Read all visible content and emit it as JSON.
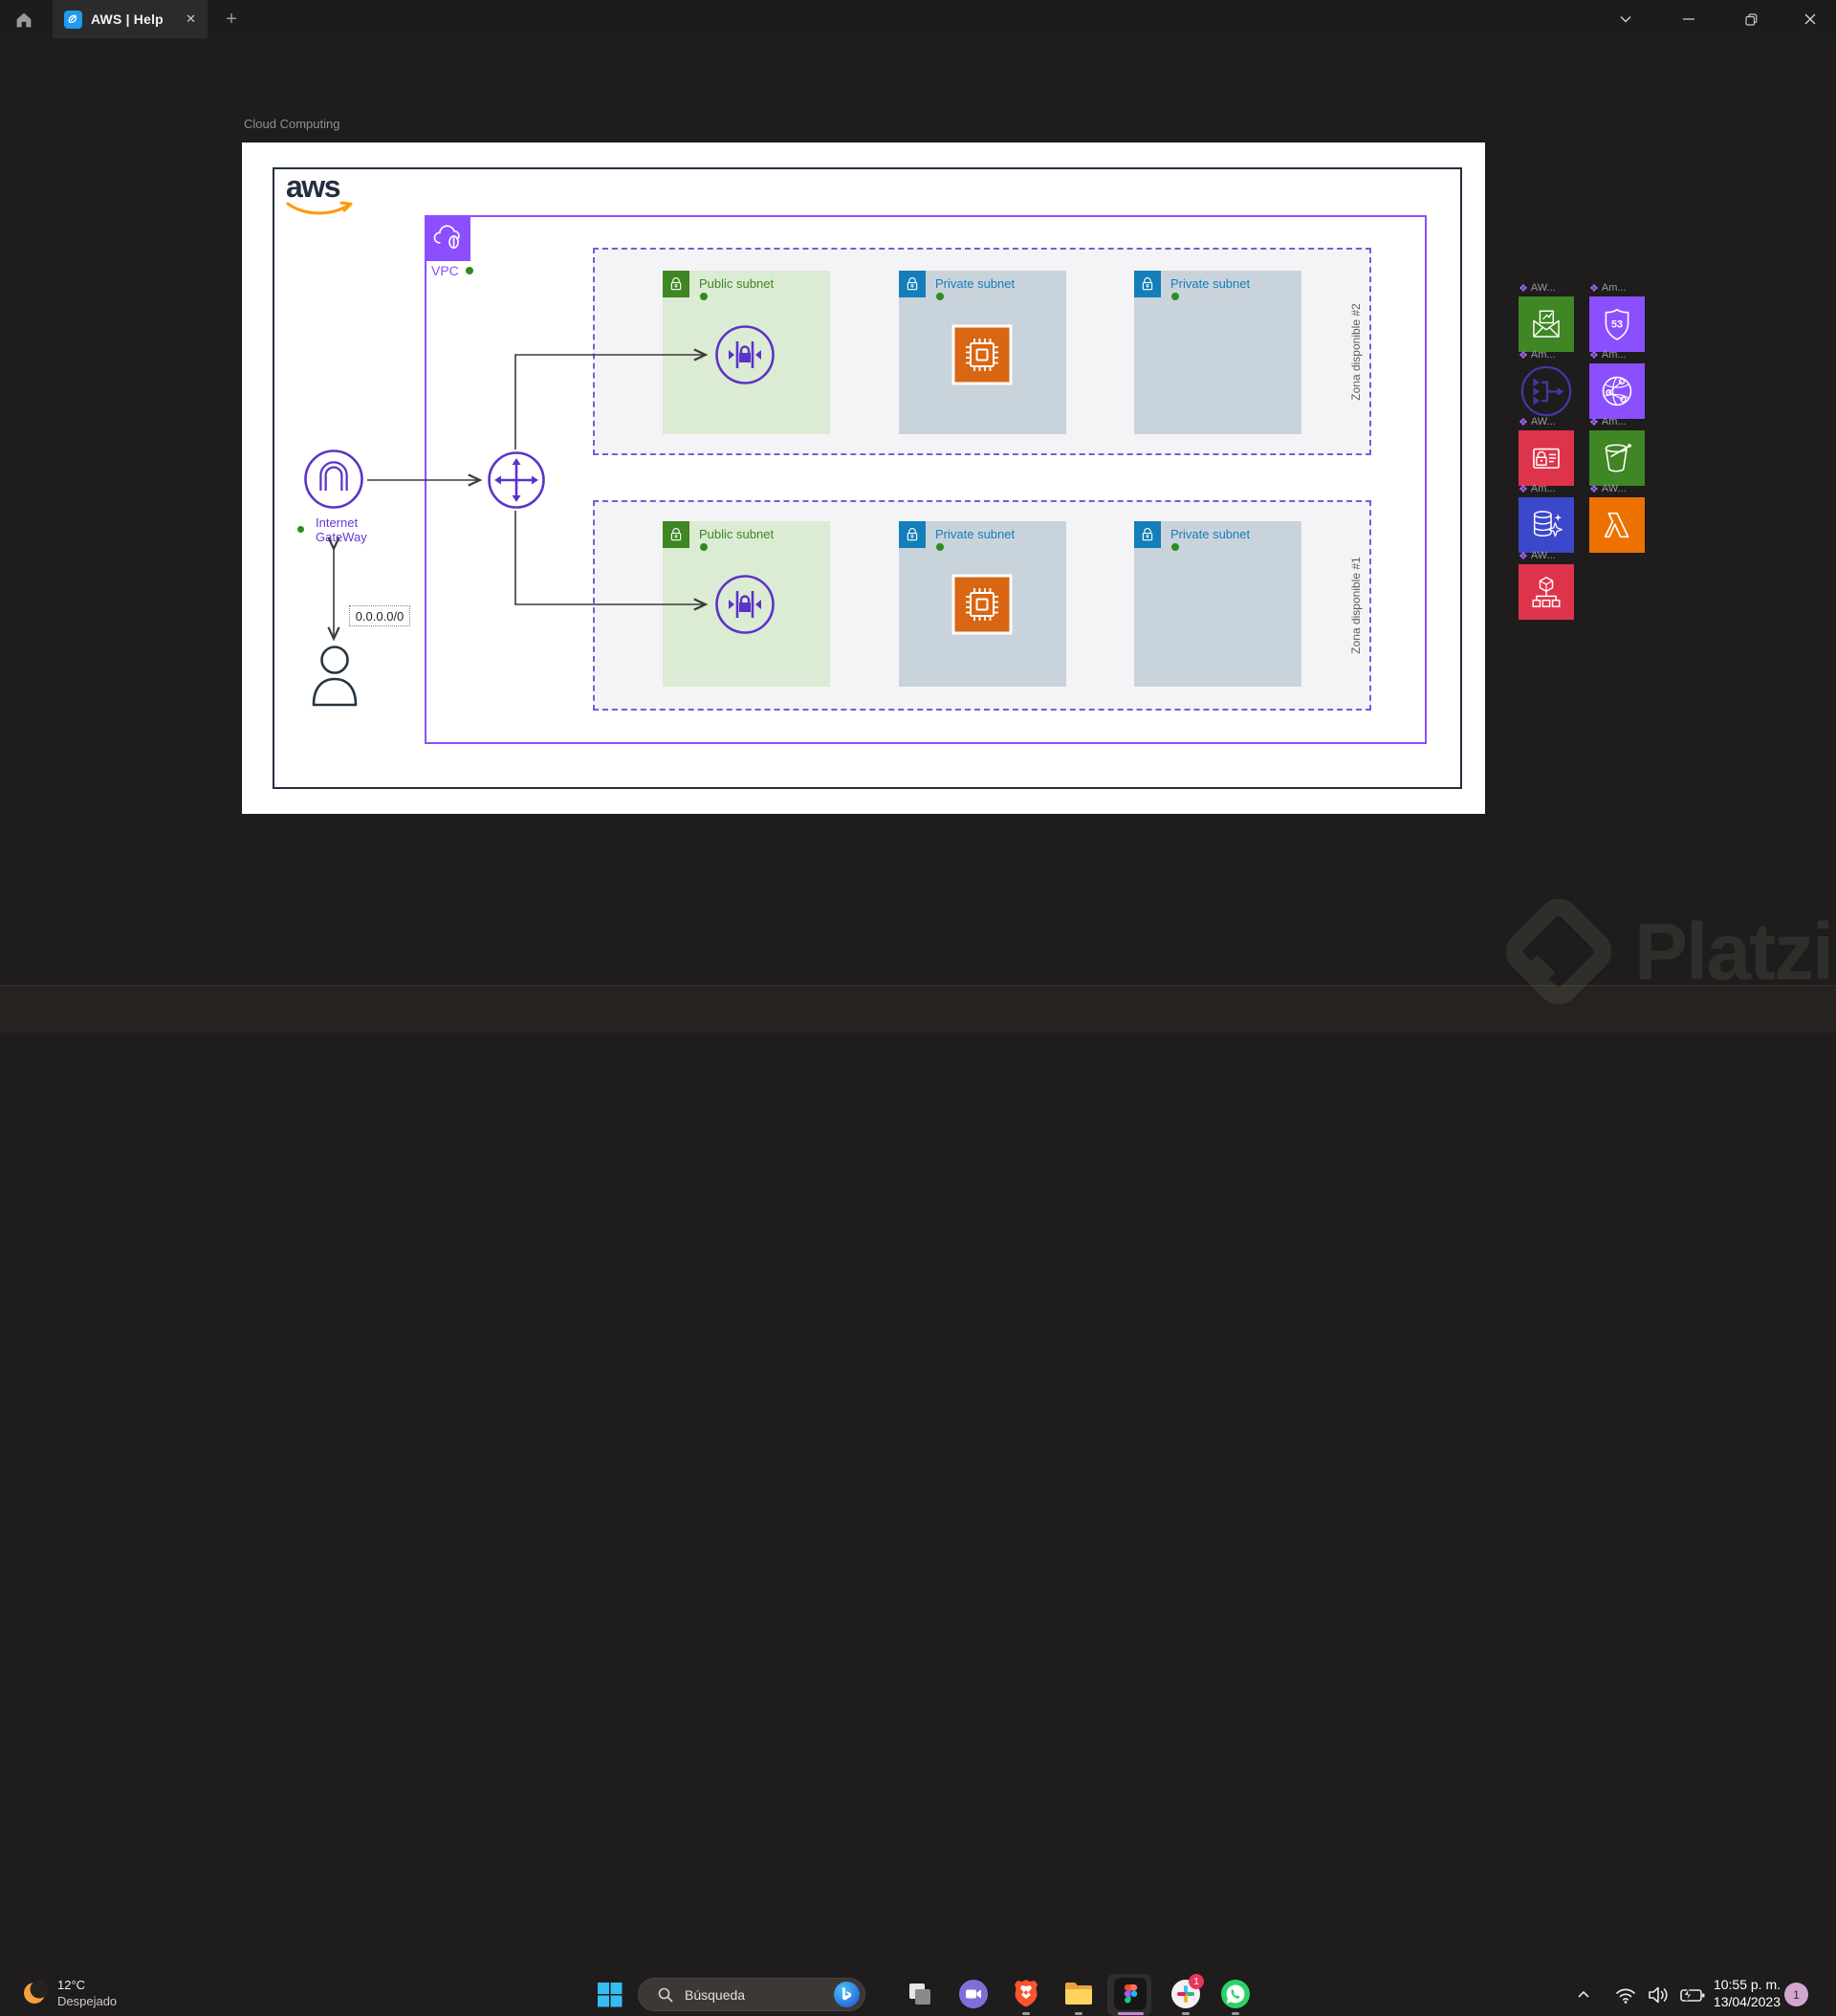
{
  "window": {
    "tab": {
      "title": "AWS | Help"
    },
    "new_tab_label": "+"
  },
  "canvas": {
    "frame_label": "Cloud Computing",
    "aws_logo_text": "aws",
    "vpc": {
      "label": "VPC"
    },
    "internet_gateway": {
      "label_line1": "Internet",
      "label_line2": "GateWay"
    },
    "route_cidr": "0.0.0.0/0",
    "zones": [
      {
        "name": "Zona disponible #2",
        "subnets": [
          {
            "label": "Public subnet",
            "type": "public"
          },
          {
            "label": "Private subnet",
            "type": "private",
            "has_ec2": true
          },
          {
            "label": "Private subnet",
            "type": "private",
            "has_ec2": false
          }
        ]
      },
      {
        "name": "Zona disponible #1",
        "subnets": [
          {
            "label": "Public subnet",
            "type": "public"
          },
          {
            "label": "Private subnet",
            "type": "private",
            "has_ec2": true
          },
          {
            "label": "Private subnet",
            "type": "private",
            "has_ec2": false
          }
        ]
      }
    ]
  },
  "palette": {
    "diamond_icon": "❖",
    "items": [
      {
        "label": "AW...",
        "icon": "ses-mail-icon",
        "color": "#3F8624"
      },
      {
        "label": "Am...",
        "icon": "route53-shield-icon",
        "color": "#8C4FFF"
      },
      {
        "label": "Am...",
        "icon": "elastic-load-balancer-icon",
        "color": "outline-purple"
      },
      {
        "label": "Am...",
        "icon": "cloudfront-globe-icon",
        "color": "#8C4FFF"
      },
      {
        "label": "AW...",
        "icon": "secrets-manager-icon",
        "color": "#DD344C"
      },
      {
        "label": "Am...",
        "icon": "s3-bucket-icon",
        "color": "#3F8624"
      },
      {
        "label": "Am...",
        "icon": "aurora-database-icon",
        "color": "#3B48CC"
      },
      {
        "label": "AW...",
        "icon": "lambda-icon",
        "color": "#ED7100"
      },
      {
        "label": "AW...",
        "icon": "organizations-cube-icon",
        "color": "#DD344C"
      }
    ]
  },
  "taskbar": {
    "weather": {
      "temp": "12°C",
      "condition": "Despejado"
    },
    "search": {
      "placeholder": "Búsqueda"
    },
    "apps": [
      "task-view",
      "video-call",
      "brave",
      "file-explorer",
      "figma",
      "slack",
      "whatsapp"
    ],
    "slack_badge": "1",
    "tray": {
      "time": "10:55 p. m.",
      "date": "13/04/2023",
      "badge": "1"
    }
  },
  "watermark": {
    "text": "Platzi"
  },
  "colors": {
    "aws_orange": "#FF9900",
    "vpc_purple": "#8C4FFF",
    "icon_purple": "#5C33C8",
    "public_green": "#3F8624",
    "private_blue": "#147EBA",
    "ec2_orange": "#D86613",
    "red": "#DD344C",
    "lambda_orange": "#ED7100",
    "db_blue": "#3B48CC"
  }
}
